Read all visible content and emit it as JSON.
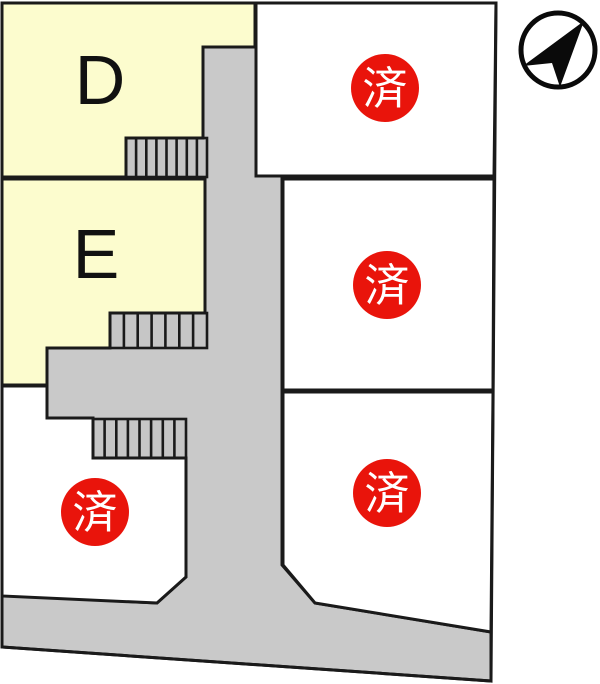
{
  "lots": {
    "available": [
      {
        "id": "D",
        "label": "D",
        "status": "available"
      },
      {
        "id": "E",
        "label": "E",
        "status": "available"
      }
    ],
    "sold": [
      {
        "position": "top-right",
        "label": "済"
      },
      {
        "position": "middle-right",
        "label": "済"
      },
      {
        "position": "bottom-right",
        "label": "済"
      },
      {
        "position": "bottom-left",
        "label": "済"
      }
    ],
    "sold_stamp_meaning": "済",
    "sold_count": 4
  },
  "colors": {
    "available_lot_fill": "#FCFCCE",
    "vacant_lot_fill": "#FFFFFF",
    "road_fill": "#C9C9C9",
    "outline": "#1A1A1A",
    "sold_badge_fill": "#E9140B",
    "sold_badge_text": "#FFFFFF"
  },
  "icons": {
    "compass": "north-arrow-icon"
  }
}
